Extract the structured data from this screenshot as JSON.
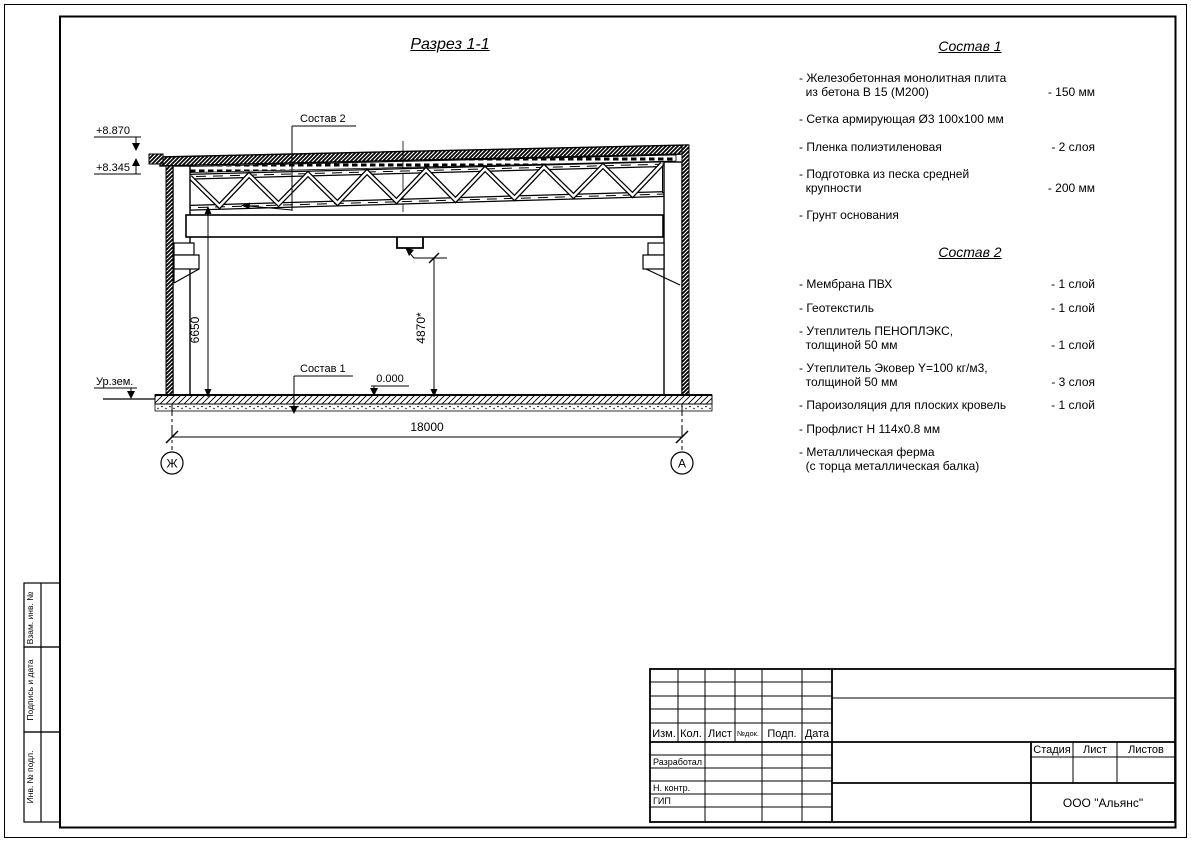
{
  "sheet": {
    "drawing_title": "Разрез 1-1"
  },
  "drawing": {
    "callout_roof": "Состав 2",
    "callout_floor": "Состав 1",
    "elev_parapet": "+8.870",
    "elev_truss": "+8.345",
    "elev_zero": "0.000",
    "ground_label": "Ур.зем.",
    "dim_clear_height": "6650",
    "dim_hook_height": "4870*",
    "dim_span": "18000",
    "axis_left": "Ж",
    "axis_right": "А"
  },
  "spec1": {
    "title": "Состав 1",
    "items": [
      {
        "name": "- Железобетонная  монолитная плита\n  из бетона В 15 (М200)",
        "value": "- 150 мм"
      },
      {
        "name": "- Сетка армирующая Ø3 100х100 мм",
        "value": ""
      },
      {
        "name": "- Пленка полиэтиленовая",
        "value": "- 2 слоя"
      },
      {
        "name": "- Подготовка из песка средней\n  крупности",
        "value": "- 200 мм"
      },
      {
        "name": "- Грунт основания",
        "value": ""
      }
    ]
  },
  "spec2": {
    "title": "Состав 2",
    "items": [
      {
        "name": "- Мембрана ПВХ",
        "value": "- 1 слой"
      },
      {
        "name": "- Геотекстиль",
        "value": "- 1 слой"
      },
      {
        "name": "- Утеплитель ПЕНОПЛЭКС,\n  толщиной 50 мм",
        "value": "- 1 слой"
      },
      {
        "name": "- Утеплитель Эковер Y=100 кг/м3,\n  толщиной 50 мм",
        "value": "- 3 слоя"
      },
      {
        "name": "- Пароизоляция для плоских кровель",
        "value": "- 1 слой"
      },
      {
        "name": "- Профлист Н 114х0.8 мм",
        "value": ""
      },
      {
        "name": "- Металлическая ферма\n  (с торца металлическая балка)",
        "value": ""
      }
    ]
  },
  "titleblock": {
    "cols": [
      "Изм.",
      "Кол.",
      "Лист",
      "№док.",
      "Подп.",
      "Дата"
    ],
    "roles": [
      "Разработал",
      "Н. контр.",
      "ГИП"
    ],
    "stage_cols": [
      "Стадия",
      "Лист",
      "Листов"
    ],
    "company": "ООО \"Альянс\""
  },
  "margin_stamps": [
    "Взам. инв. №",
    "Подпись и дата",
    "Инв. № подл."
  ]
}
